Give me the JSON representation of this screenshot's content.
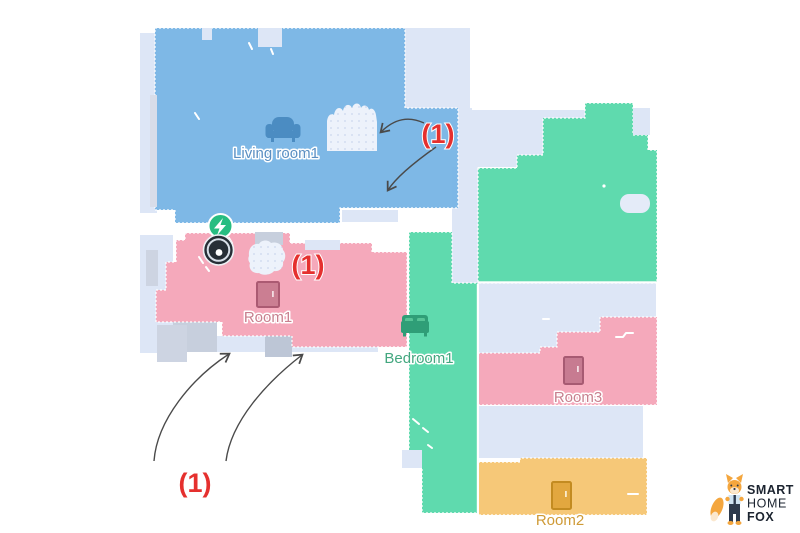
{
  "title": "Robot vacuum app floor map with numbered annotations",
  "colors": {
    "canvas": "#ffffff",
    "unexplored": "#dde6f6",
    "obstacle": "#c7cfdd",
    "carpet": "#edf2fb",
    "living_room": "#7cb7e6",
    "pink_room": "#f5a9bb",
    "green_room": "#5fdaae",
    "yellow_room": "#f6c878",
    "annotation_red": "#e5302e",
    "arrow": "#4a4a4a",
    "dock_green": "#27bd81",
    "robot_body": "#272e36",
    "logo_text": "#1c2430",
    "fox_orange": "#f4a63e"
  },
  "map": {
    "rooms": [
      {
        "id": "living-room1",
        "label": "Living room1",
        "color": "#7cb7e6",
        "label_color": "#5a8fc2",
        "icon": "couch-icon"
      },
      {
        "id": "room1",
        "label": "Room1",
        "color": "#f5a9bb",
        "label_color": "#c8808f",
        "icon": "door-icon"
      },
      {
        "id": "bedroom1",
        "label": "Bedroom1",
        "color": "#5fdaae",
        "label_color": "#43a77f",
        "icon": "bed-icon"
      },
      {
        "id": "room3",
        "label": "Room3",
        "color": "#f5a9bb",
        "label_color": "#c8808f",
        "icon": "door-icon"
      },
      {
        "id": "room2",
        "label": "Room2",
        "color": "#f6c878",
        "label_color": "#cf9a36",
        "icon": "door-icon"
      }
    ],
    "annotations": [
      {
        "id": "annotation-living-room",
        "text": "(1)"
      },
      {
        "id": "annotation-room1",
        "text": "(1)"
      },
      {
        "id": "annotation-bottom",
        "text": "(1)"
      }
    ],
    "markers": {
      "dock": "charging-dock-icon",
      "robot": "robot-vacuum-icon"
    }
  },
  "logo": {
    "line1": "SMART",
    "line2": "HOME",
    "line3": "FOX"
  }
}
